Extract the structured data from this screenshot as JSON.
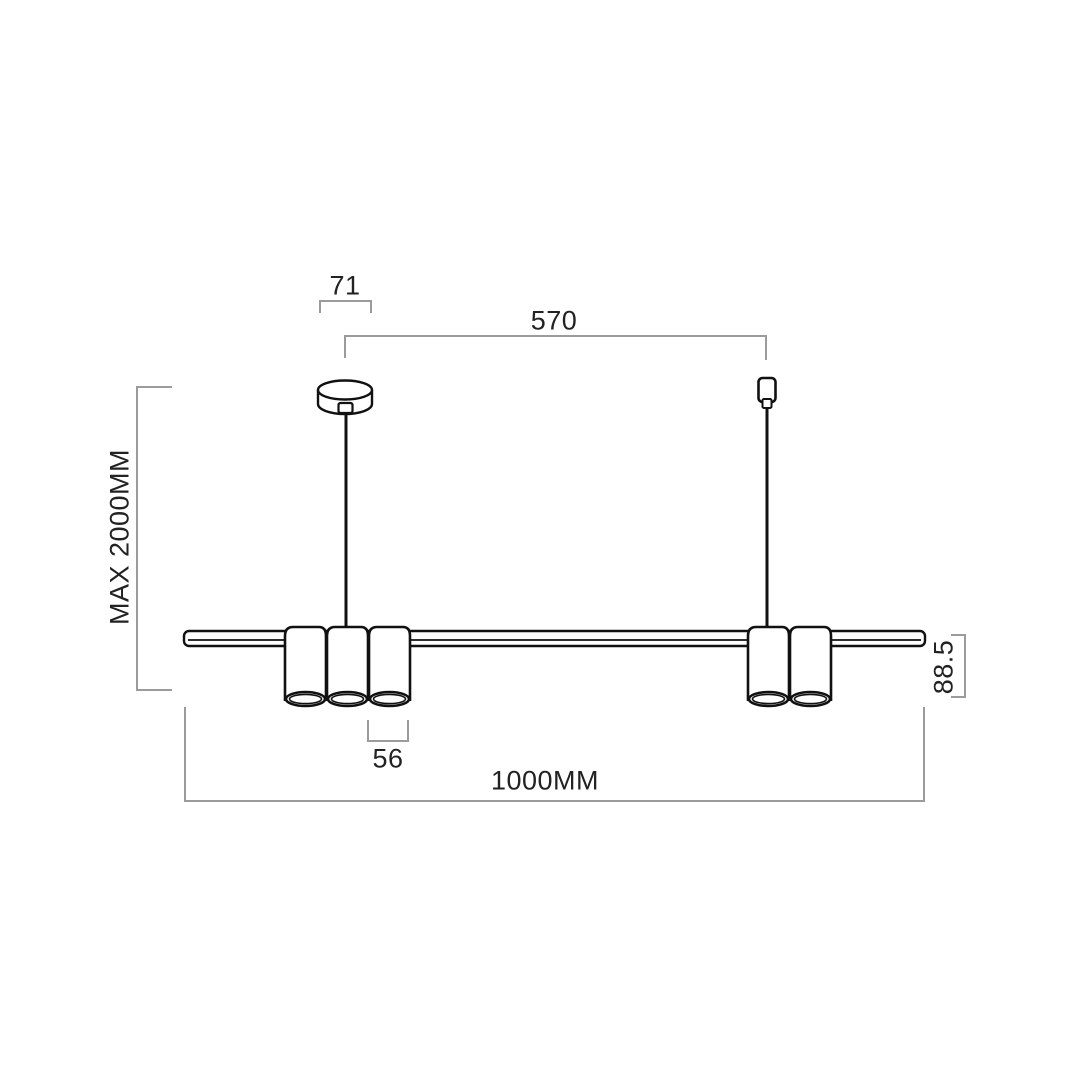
{
  "diagram": {
    "labels": {
      "canopy_width": "71",
      "suspension_spacing": "570",
      "max_suspension_height": "MAX 2000MM",
      "shade_diameter": "56",
      "fixture_length": "1000MM",
      "fixture_height": "88.5"
    },
    "colors": {
      "background": "#ffffff",
      "drawing_line": "#111111",
      "dimension_line": "#9b9b9b",
      "text": "#222222"
    }
  }
}
